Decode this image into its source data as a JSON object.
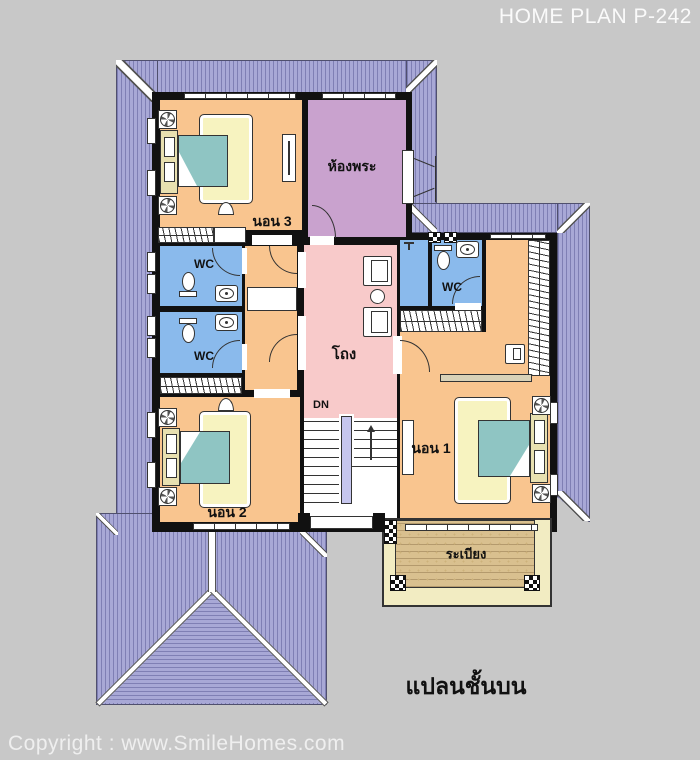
{
  "header": {
    "title": "HOME PLAN P-242"
  },
  "footer": {
    "copyright_text": "Copyright : www.SmileHomes.com"
  },
  "plan": {
    "caption": "แปลนชั้นบน",
    "rooms": {
      "bedroom3": {
        "label": "นอน 3"
      },
      "prayer_room": {
        "label": "ห้องพระ"
      },
      "wc_upper": {
        "label": "WC"
      },
      "wc_lower": {
        "label": "WC"
      },
      "wc_master": {
        "label": "WC"
      },
      "hall": {
        "label": "โถง"
      },
      "bedroom1": {
        "label": "นอน 1"
      },
      "bedroom2": {
        "label": "นอน 2"
      },
      "balcony": {
        "label": "ระเบียง"
      },
      "stairs": {
        "label": "DN"
      }
    },
    "colors": {
      "background": "#c8c8c8",
      "roof": "#a8a8d6",
      "roof_line": "#7f7fb4",
      "floor_bedroom": "#f9c58f",
      "floor_prayer": "#c9a2ce",
      "floor_hall": "#f8caca",
      "floor_wc": "#8abaec",
      "deck_wood": "#d9c08f",
      "rug": "#f7f3c0",
      "bed": "#8fc5c3",
      "railing": "#f2ecc2"
    }
  }
}
